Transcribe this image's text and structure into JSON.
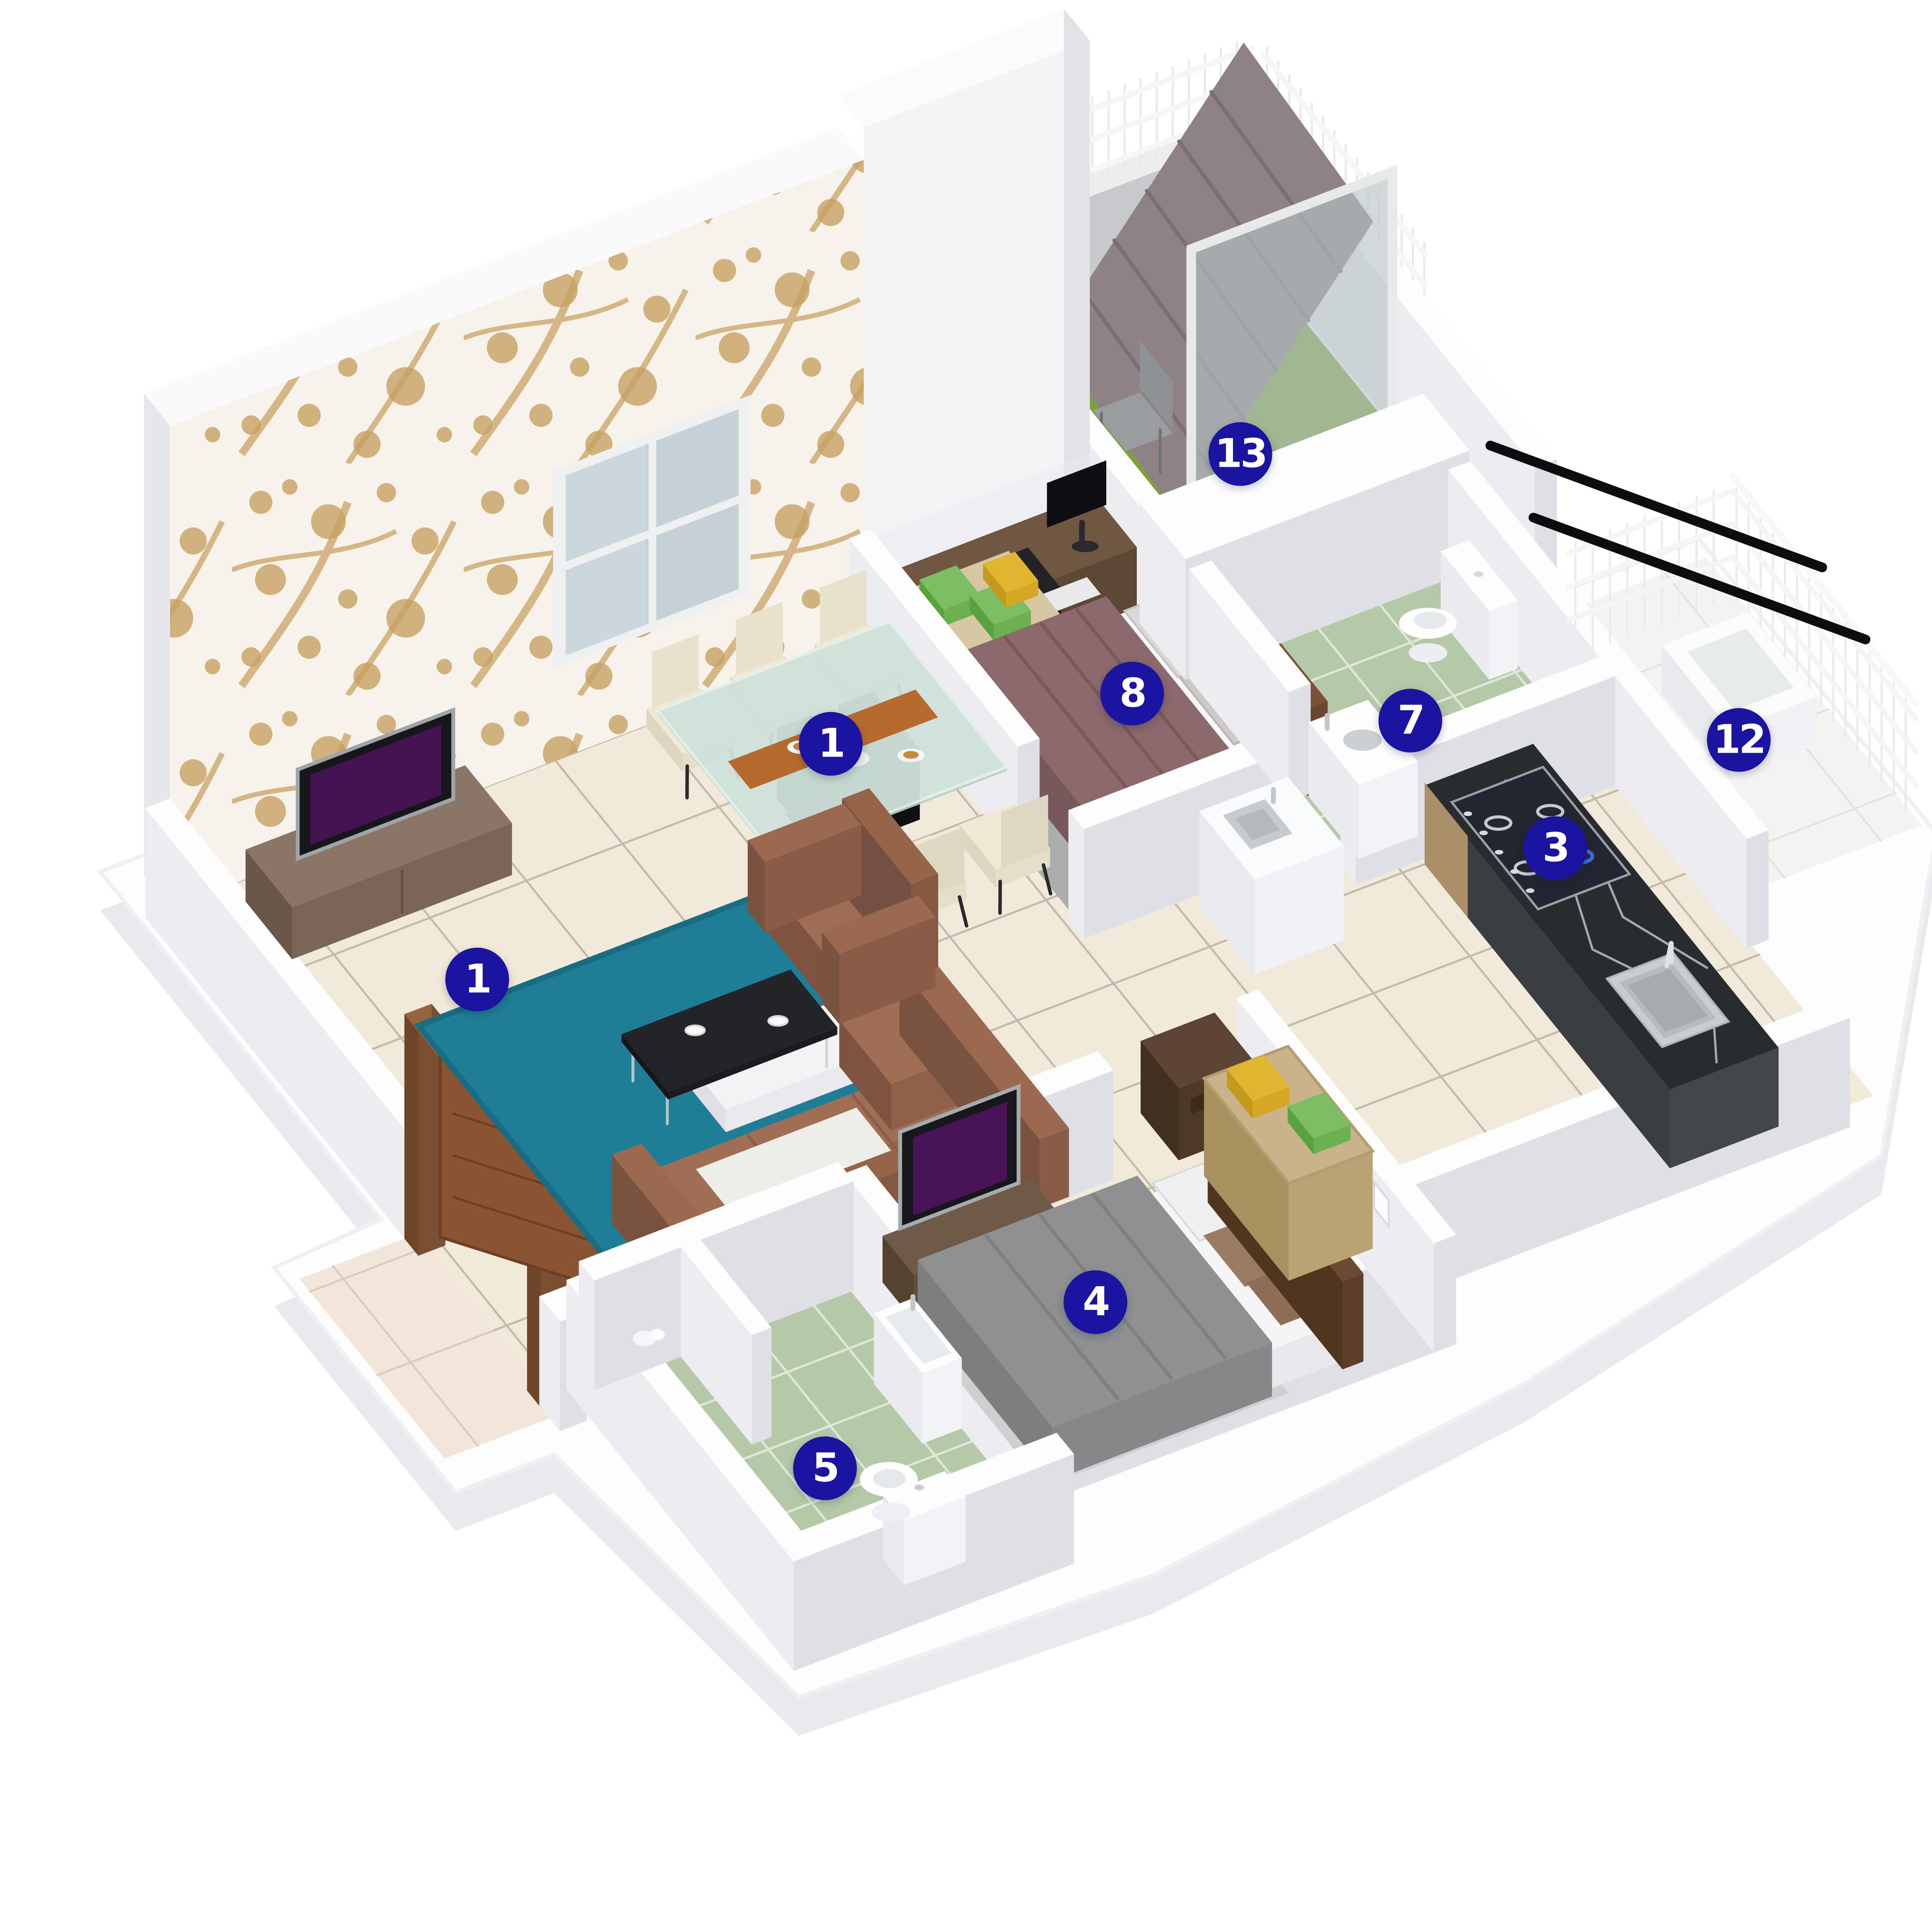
{
  "image_type": "3d-isometric-apartment-floor-plan-render",
  "palette": {
    "background": "#ffffff",
    "marker": "#1a14a0",
    "marker_text": "#ffffff",
    "floor_tile": "#f1e9da",
    "tile_grout": "#c3bcae",
    "bath_tile": "#b5c9a8",
    "bath_grout": "#dfe8d8",
    "balcony_turf": "#7ba23c",
    "wall_white": "#fdfdfe",
    "wallpaper_accent": "#c8a265",
    "rug_teal": "#1f7e95",
    "sofa_brown": "#a06e54",
    "bed_mauve": "#8b696c",
    "bed_gray": "#8e9092",
    "kitchen_counter": "#292c2e",
    "wood_door": "#8a5433",
    "glass": "#b6c3c7"
  },
  "markers": [
    {
      "number": "1",
      "room": "living-room",
      "x_pct": 24.7,
      "y_pct": 50.7
    },
    {
      "number": "1",
      "room": "dining-area",
      "x_pct": 43.0,
      "y_pct": 38.5
    },
    {
      "number": "3",
      "room": "kitchen",
      "x_pct": 80.5,
      "y_pct": 43.9
    },
    {
      "number": "4",
      "room": "bedroom-2",
      "x_pct": 56.7,
      "y_pct": 67.4
    },
    {
      "number": "5",
      "room": "bathroom-2",
      "x_pct": 42.7,
      "y_pct": 76.0
    },
    {
      "number": "7",
      "room": "bathroom-1",
      "x_pct": 73.0,
      "y_pct": 37.3
    },
    {
      "number": "8",
      "room": "bedroom-1",
      "x_pct": 58.6,
      "y_pct": 35.9
    },
    {
      "number": "12",
      "room": "utility",
      "x_pct": 90.0,
      "y_pct": 38.3
    },
    {
      "number": "13",
      "room": "balcony",
      "x_pct": 64.2,
      "y_pct": 23.5
    }
  ]
}
